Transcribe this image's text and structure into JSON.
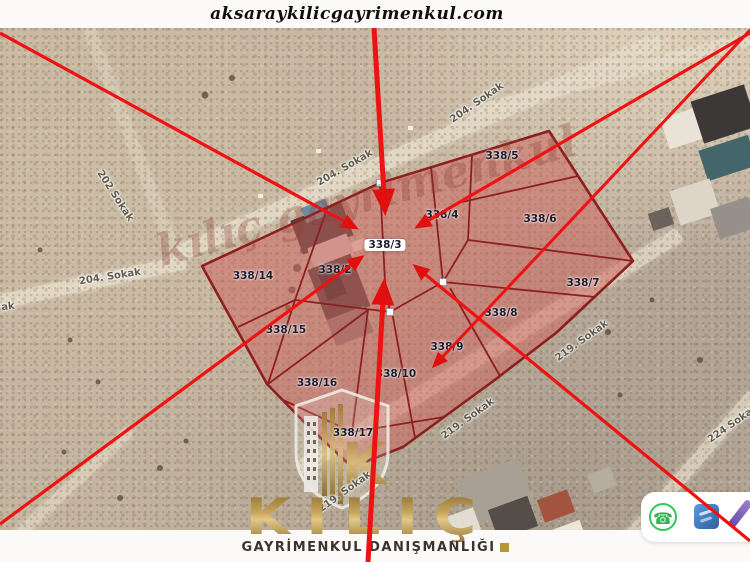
{
  "header": {
    "website_url": "aksaraykilicgayrimenkul.com"
  },
  "map": {
    "watermark": "kılıç gayrimenkul",
    "parcel_labels": [
      {
        "text": "338/5",
        "x": 502,
        "y": 156,
        "highlight": false
      },
      {
        "text": "338/4",
        "x": 442,
        "y": 215,
        "highlight": false
      },
      {
        "text": "338/6",
        "x": 540,
        "y": 219,
        "highlight": false
      },
      {
        "text": "338/3",
        "x": 385,
        "y": 245,
        "highlight": true
      },
      {
        "text": "338/2",
        "x": 335,
        "y": 270,
        "highlight": false
      },
      {
        "text": "338/14",
        "x": 253,
        "y": 276,
        "highlight": false
      },
      {
        "text": "338/7",
        "x": 583,
        "y": 283,
        "highlight": false
      },
      {
        "text": "338/8",
        "x": 501,
        "y": 313,
        "highlight": false
      },
      {
        "text": "338/15",
        "x": 286,
        "y": 330,
        "highlight": false
      },
      {
        "text": "338/9",
        "x": 447,
        "y": 347,
        "highlight": false
      },
      {
        "text": "338/10",
        "x": 396,
        "y": 374,
        "highlight": false
      },
      {
        "text": "338/16",
        "x": 317,
        "y": 383,
        "highlight": false
      },
      {
        "text": "338/17",
        "x": 353,
        "y": 433,
        "highlight": false
      }
    ],
    "street_labels": [
      {
        "text": "204. Sokak",
        "x": 345,
        "y": 168,
        "rot": -30
      },
      {
        "text": "204. Sokak",
        "x": 477,
        "y": 103,
        "rot": -35
      },
      {
        "text": "204. Sokak",
        "x": 110,
        "y": 277,
        "rot": -9
      },
      {
        "text": "202 Sokak",
        "x": 115,
        "y": 196,
        "rot": 57
      },
      {
        "text": "ak",
        "x": 8,
        "y": 307,
        "rot": -8
      },
      {
        "text": "219. Sokak",
        "x": 582,
        "y": 341,
        "rot": -36
      },
      {
        "text": "219. Sokak",
        "x": 468,
        "y": 419,
        "rot": -36
      },
      {
        "text": "219. Sokak",
        "x": 345,
        "y": 492,
        "rot": -36
      },
      {
        "text": "224 Sokak",
        "x": 733,
        "y": 424,
        "rot": -35
      }
    ]
  },
  "branding": {
    "logo_text": "KILIÇ",
    "logo_monogram": "K",
    "tagline": "GAYRİMENKUL DANIŞMANLIĞI"
  },
  "toolbar": {
    "whatsapp_glyph": "☎",
    "icons": [
      "whatsapp-icon",
      "gallery-icon",
      "pen-icon"
    ]
  },
  "colors": {
    "arrow_red": "#ef1212",
    "parcel_fill": "rgba(205,95,92,0.5)",
    "parcel_stroke": "#8e1f1f",
    "brand_gold": "#c9a75a"
  }
}
